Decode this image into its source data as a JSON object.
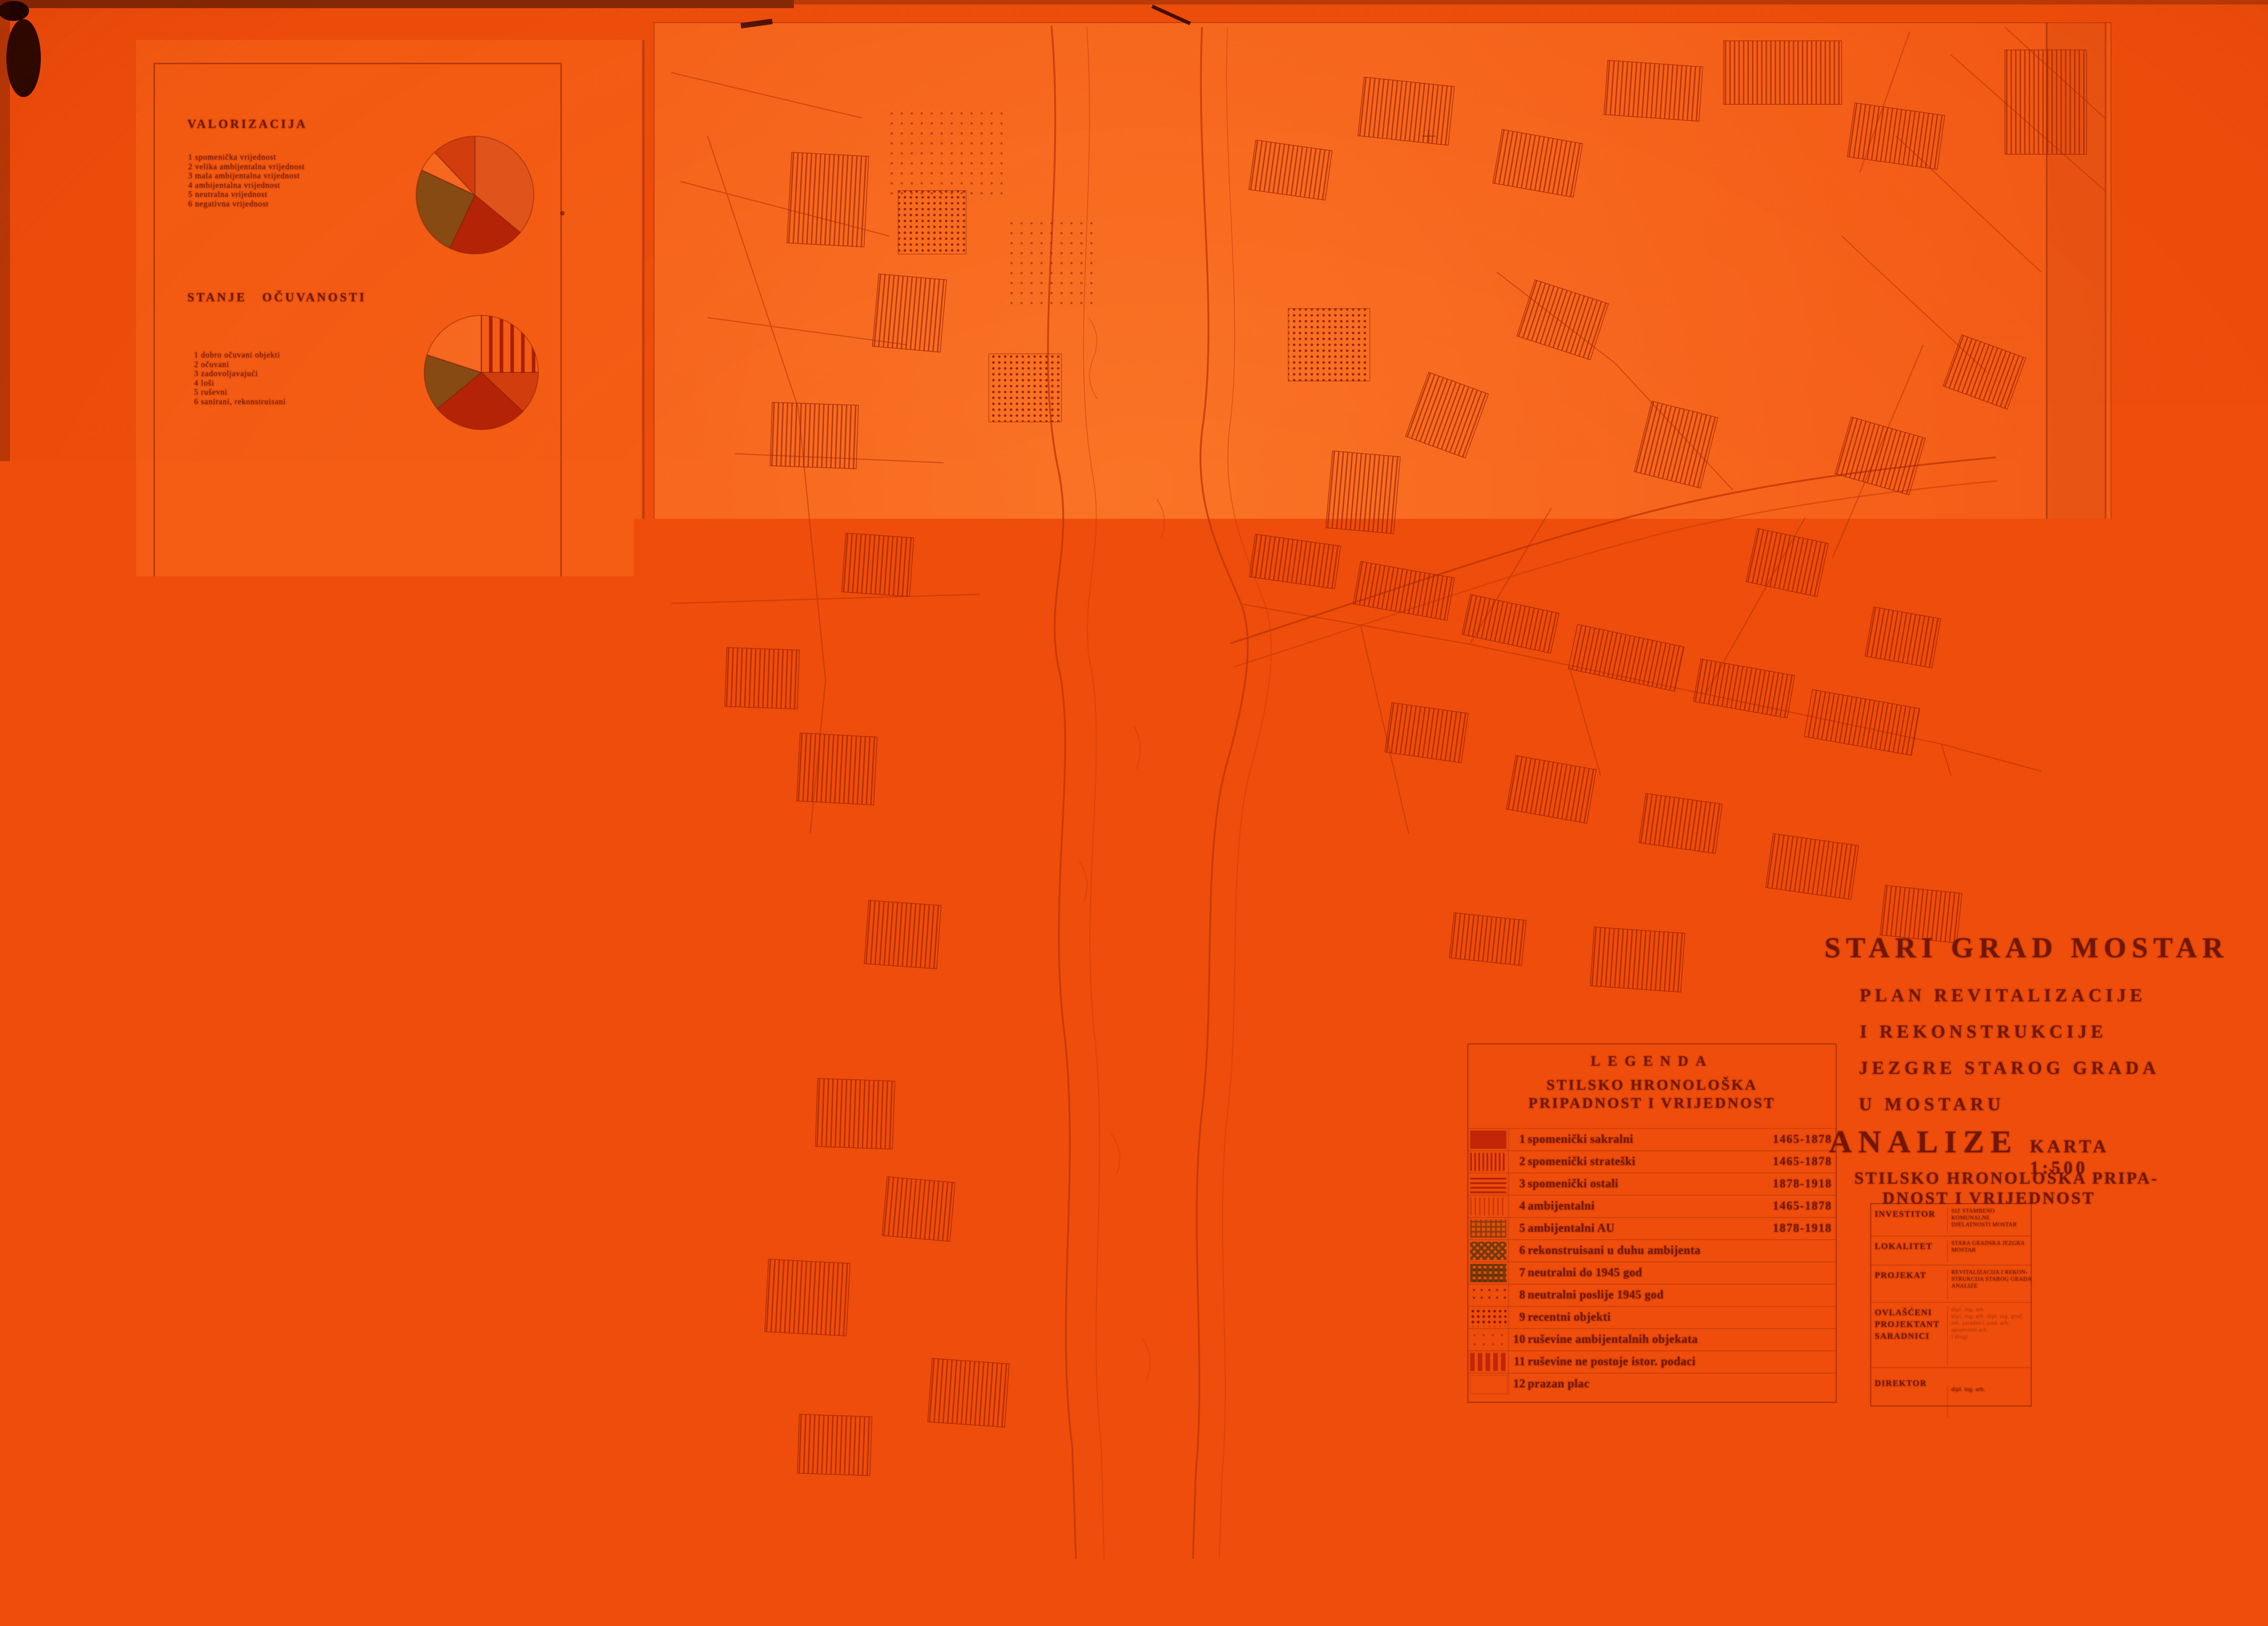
{
  "slide": {
    "date_note": "SEPTEMBAR 1978."
  },
  "left_panel": {
    "sections": [
      {
        "title": "VALORIZACIJA",
        "items": [
          "1 spomenička vrijednost",
          "2 velika ambijentalna vrijednost",
          "3 mala ambijentalna vrijednost",
          "4 ambijentalna vrijednost",
          "5 neutralna vrijednost",
          "6 negativna vrijednost"
        ]
      },
      {
        "title": "STANJE OČUVANOSTI",
        "items": [
          "1 dobro očuvani objekti",
          "2 očuvani",
          "3 zadovoljavajući",
          "4 loši",
          "5 ruševni",
          "6 sanirani, rekonstruisani"
        ]
      },
      {
        "title": "KROV I POKROV",
        "items": [
          "1 kosi krov",
          "2 ravan krov",
          "3 šator krov",
          "4 kupola",
          "5 kamena ploča",
          "6 kupa kanalica",
          "7 ćeramida",
          "8 salonit ploče",
          "9 limeni pokrov"
        ]
      },
      {
        "title": "STILSKO HRONOLOŠKA",
        "title2": "PRIPADNOST I VRIJEDNOST",
        "items": [
          "1 spomenički sakralni 1465-1878",
          "2 spomenički strateški 1465-1878",
          "3 spomenički ostali 1878-1918",
          "4 ambijentalni 1465-1878",
          "5 ambijentalni AU 1878-1918",
          "6 rekonstruisani u duhu ambijenta",
          "7 neutralni do 1945 god",
          "8 neutralni poslije 1945 god",
          "9 recentni objekti",
          "10 ruševine ambijentalnih objekata",
          "11 ruševine ne postoje istor. podaci",
          "12 prazan plac"
        ]
      },
      {
        "title": "ZIDOVI I FASADE",
        "items": [
          "1 pravilni tesani kamen",
          "2 lomljeni kamen, dersovan",
          "3 lomljeni kamen, malterisan",
          "4 opeka",
          "5 čerpič i ćatma",
          "6 bondruk, plet",
          "7 AB noseći sa ispunom od kamena",
          "8 AB paneli, nove fasadne obloge"
        ]
      },
      {
        "title": "MEĐU-SPRAT, STEPENIŠTE",
        "items": [
          "1 svod",
          "2 drvena i malter",
          "3 drvena greda",
          "4 AB ploča i drvene grede",
          "5 AB ploča",
          "6 kameno",
          "7 drveno",
          "8 AB",
          "9 metalno",
          "10 kombinovano"
        ]
      }
    ],
    "footnote": "Karta izgrađena je u granicama zahvata revitalizacije  -  obradila služba tehničke zaštite starog grada"
  },
  "logo": {
    "small_print_1": "Kartu izradila je služba tehničke zaštite i",
    "small_print_2": "obnove spomeničkog naslijeđa",
    "brand_1": "·Stari grad·",
    "brand_2": "Mostar",
    "sub_left": "žiro račun",
    "sub_right": "35800-603-45",
    "sub_line": "Telefon 35-45, Mostar SFRJ",
    "address": "Ul. M. Tita br. 16"
  },
  "map": {
    "label_radobolja": "Radobolja",
    "label_neretva": "Neretva"
  },
  "title_block": {
    "line1": "STARI GRAD MOSTAR",
    "line2": "PLAN REVITALIZACIJE",
    "line3": "I REKONSTRUKCIJE",
    "line4": "JEZGRE STAROG GRADA",
    "line5": "U MOSTARU",
    "analize": "ANALIZE",
    "karta": "KARTA 1:500",
    "sub1": "STILSKO HRONOLOŠKA PRIPA-",
    "sub2": "DNOST I VRIJEDNOST"
  },
  "legend": {
    "title": "LEGENDA",
    "subtitle1": "STILSKO HRONOLOŠKA",
    "subtitle2": "PRIPADNOST I VRIJEDNOST",
    "rows": [
      {
        "num": "1",
        "label": "spomenički sakralni",
        "years": "1465-1878",
        "pattern": "solid"
      },
      {
        "num": "2",
        "label": "spomenički strateški",
        "years": "1465-1878",
        "pattern": "vlines"
      },
      {
        "num": "3",
        "label": "spomenički ostali",
        "years": "1878-1918",
        "pattern": "hlines"
      },
      {
        "num": "4",
        "label": "ambijentalni",
        "years": "1465-1878",
        "pattern": "vlight"
      },
      {
        "num": "5",
        "label": "ambijentalni AU",
        "years": "1878-1918",
        "pattern": "cross"
      },
      {
        "num": "6",
        "label": "rekonstruisani u duhu ambijenta",
        "years": "",
        "pattern": "crossdark"
      },
      {
        "num": "7",
        "label": "neutralni do 1945 god",
        "years": "",
        "pattern": "checker"
      },
      {
        "num": "8",
        "label": "neutralni poslije 1945 god",
        "years": "",
        "pattern": "dotsparse"
      },
      {
        "num": "9",
        "label": "recentni objekti",
        "years": "",
        "pattern": "dots"
      },
      {
        "num": "10",
        "label": "ruševine ambijentalnih objekata",
        "years": "",
        "pattern": "dotfaint"
      },
      {
        "num": "11",
        "label": "ruševine ne postoje istor. podaci",
        "years": "",
        "pattern": "dash"
      },
      {
        "num": "12",
        "label": "prazan plac",
        "years": "",
        "pattern": "empty"
      }
    ]
  },
  "info_table": {
    "rows": [
      {
        "label": "INVESTITOR",
        "value": "SIZ STAMBENO KOMUNALNE\nDJELATNOSTI MOSTAR"
      },
      {
        "label": "LOKALITET",
        "value": "STARA GRADSKA JEZGRA\nMOSTAR"
      },
      {
        "label": "PROJEKAT",
        "value": "REVITALIZACIJA I REKON-\nSTRUKCIJA STAROG GRADA\nANALIZE"
      },
      {
        "label": "OVLAŠĆENI\nPROJEKTANT\nSARADNICI",
        "value": "dipl. ing. arh.\ndipl. ing. arh.   dipl. ing. građ.\nteh. saradnici   stud. arh.\napsolventi arh.\ni drugi"
      },
      {
        "label": "DIREKTOR",
        "value": "dipl. ing. arh."
      }
    ]
  },
  "pies": [
    {
      "name": "valorizacija-pie",
      "segments": [
        {
          "value": 36,
          "fill": "red-light"
        },
        {
          "value": 21,
          "fill": "red-dark"
        },
        {
          "value": 25,
          "fill": "olive"
        },
        {
          "value": 6,
          "fill": "paper"
        },
        {
          "value": 12,
          "fill": "red-mid"
        }
      ]
    },
    {
      "name": "stanje-ocuvanosti-pie",
      "segments": [
        {
          "value": 25,
          "fill": "vlines"
        },
        {
          "value": 12,
          "fill": "red-mid"
        },
        {
          "value": 27,
          "fill": "red-dark"
        },
        {
          "value": 16,
          "fill": "olive"
        },
        {
          "value": 20,
          "fill": "paper"
        }
      ]
    },
    {
      "name": "krov-pokrov-pie",
      "segments": [
        {
          "value": 9,
          "fill": "red-mid"
        },
        {
          "value": 16,
          "fill": "hlines"
        },
        {
          "value": 11,
          "fill": "olive"
        },
        {
          "value": 13,
          "fill": "red-dark"
        },
        {
          "value": 35,
          "fill": "paper"
        },
        {
          "value": 16,
          "fill": "vlines"
        }
      ]
    },
    {
      "name": "stilsko-hronoloska-pie",
      "segments": [
        {
          "value": 22,
          "fill": "dots"
        },
        {
          "value": 15,
          "fill": "dash"
        },
        {
          "value": 21,
          "fill": "red-mid"
        },
        {
          "value": 9,
          "fill": "olive"
        },
        {
          "value": 33,
          "fill": "paper"
        }
      ]
    },
    {
      "name": "zidovi-fasade-pie",
      "segments": [
        {
          "value": 34,
          "fill": "red-dark"
        },
        {
          "value": 18,
          "fill": "vlines"
        },
        {
          "value": 9,
          "fill": "red-mid"
        },
        {
          "value": 6,
          "fill": "dots"
        },
        {
          "value": 33,
          "fill": "paper"
        }
      ]
    },
    {
      "name": "medjusprat-stepeniste-pie",
      "segments": [
        {
          "value": 28,
          "fill": "vlines"
        },
        {
          "value": 24,
          "fill": "paper"
        },
        {
          "value": 30,
          "fill": "fan"
        },
        {
          "value": 18,
          "fill": "paper"
        }
      ]
    },
    {
      "name": "karta-summary-pie",
      "segments": [
        {
          "value": 5,
          "fill": "red-dark"
        },
        {
          "value": 24,
          "fill": "hlines"
        },
        {
          "value": 12,
          "fill": "diag"
        },
        {
          "value": 16,
          "fill": "paper"
        },
        {
          "value": 22,
          "fill": "vlines"
        },
        {
          "value": 21,
          "fill": "checker"
        }
      ]
    }
  ]
}
